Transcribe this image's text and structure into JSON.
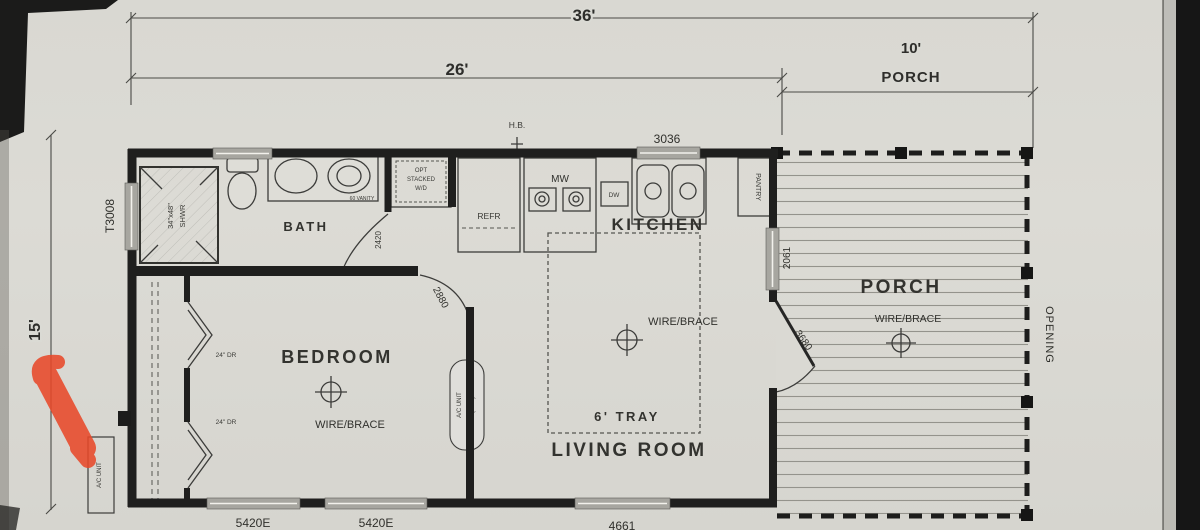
{
  "dim": {
    "w36": "36'",
    "w26": "26'",
    "w10": "10'",
    "porch_word": "PORCH",
    "d15": "15'"
  },
  "model": "T3008",
  "rooms": {
    "bath": "BATH",
    "kitchen": "KITCHEN",
    "bedroom": "BEDROOM",
    "living": "LIVING ROOM",
    "porch": "PORCH"
  },
  "ann": {
    "hb": "H.B.",
    "win3036": "3036",
    "mw": "MW",
    "refr": "REFR",
    "dw": "DW",
    "pantry": "PANTRY",
    "shower_size": "34\"x48\"",
    "shower_word": "SHWR",
    "wd1": "OPT",
    "wd2": "STACKED",
    "wd3": "W/D",
    "vanity": "60 VANITY",
    "door_bath": "2420",
    "door_bedroom": "2880",
    "door_porch": "3680",
    "win2061": "2061",
    "opening": "OPENING",
    "wire_brace": "WIRE/BRACE",
    "tray": "6' TRAY",
    "closet_door": "24\" DR",
    "win5420": [
      "5420E",
      "5420E"
    ],
    "win4661": "4661",
    "ac_unit": "A/C UNIT",
    "ac_opt": "(OPT)",
    "ac_pad": "A/C UNIT",
    "n648": "648"
  }
}
